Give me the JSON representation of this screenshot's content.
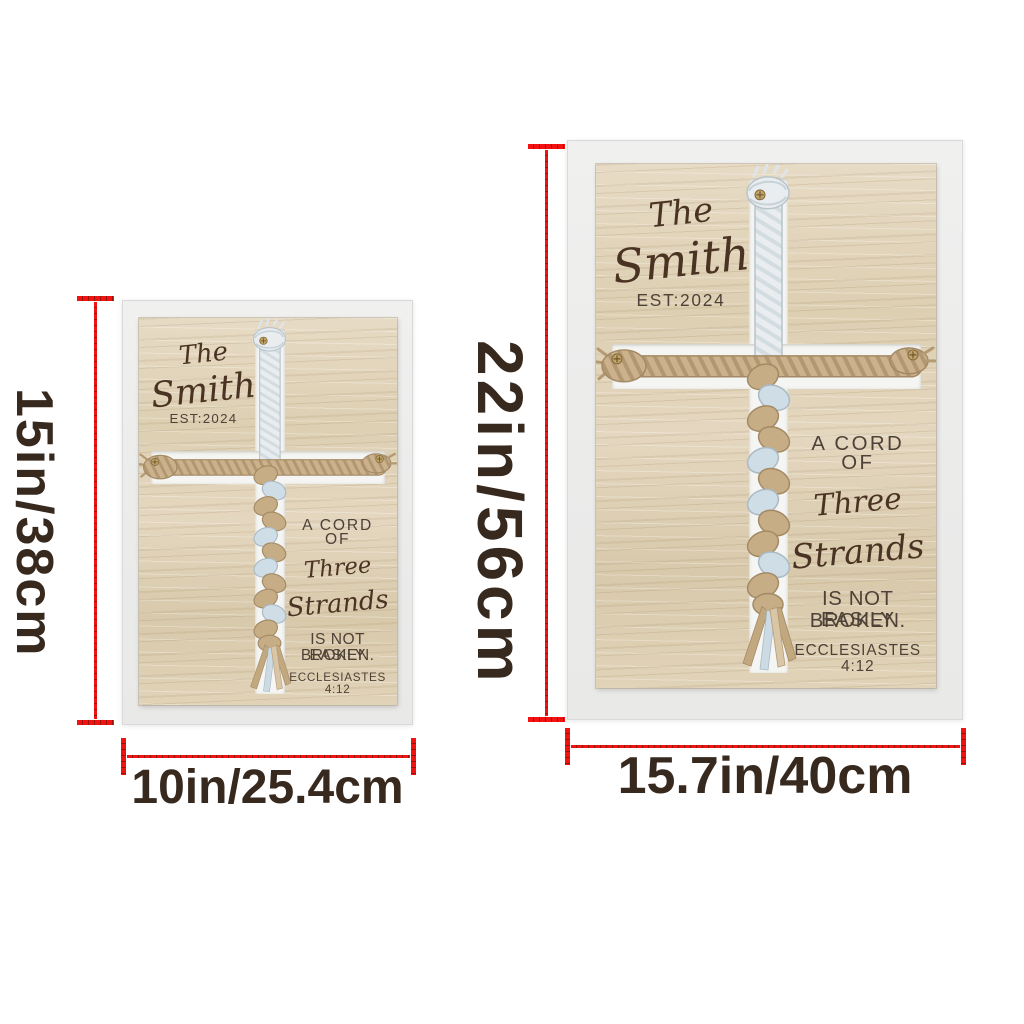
{
  "sign": {
    "family_prefix": "The",
    "family_name": "Smith",
    "established": "EST:2024",
    "verse": {
      "line1": "A CORD",
      "line2": "OF",
      "script1": "Three",
      "script2": "Strands",
      "line3": "IS NOT EASILY",
      "line4": "BROKEN.",
      "reference": "ECCLESIASTES 4:12"
    }
  },
  "dimensions": {
    "small": {
      "height": "15in/38cm",
      "width": "10in/25.4cm"
    },
    "large": {
      "height": "22in/56cm",
      "width": "15.7in/40cm"
    }
  },
  "icons": {
    "rope_cross": "braided-rope-cross-icon"
  },
  "colors": {
    "dimension_line": "#f31212",
    "dimension_text": "#38291e",
    "frame": "#ededec",
    "wood": "#ddd0b4",
    "engraving_script": "#4a3322",
    "engraving_sans": "#4e4238",
    "rope_tan": "#c6ad85",
    "rope_blue": "#cfdde6",
    "rope_white": "#e9edef"
  }
}
